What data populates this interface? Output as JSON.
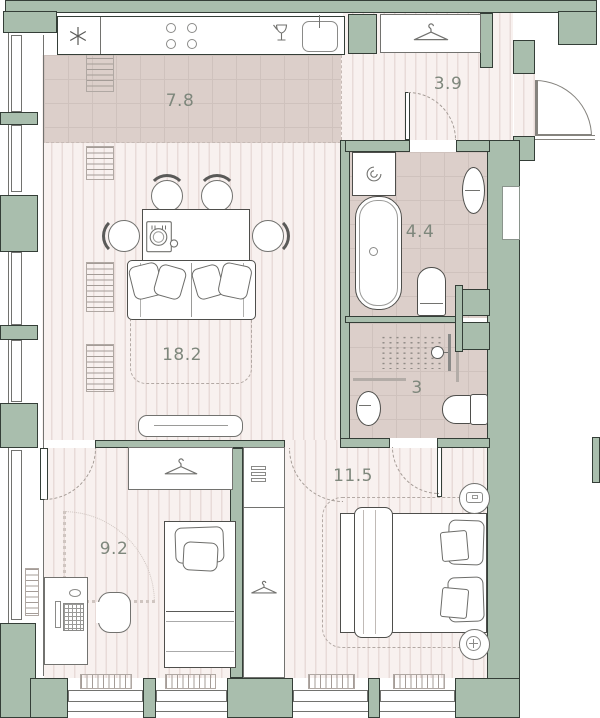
{
  "plan": {
    "rooms": {
      "kitchen": {
        "area": "7.8",
        "fixtures": [
          "fridge-icon",
          "hob-icon",
          "glass-icon",
          "sink-icon"
        ]
      },
      "hallway": {
        "area": "3.9",
        "fixtures": [
          "hanger-icon",
          "entrance-door"
        ]
      },
      "bathroom": {
        "area": "4.4",
        "fixtures": [
          "washing-machine-icon",
          "bathtub",
          "basin",
          "toilet"
        ]
      },
      "shower_room": {
        "area": "3",
        "fixtures": [
          "shower-head-icon",
          "basin",
          "toilet"
        ]
      },
      "living": {
        "area": "18.2",
        "fixtures": [
          "dining-table",
          "dining-chairs",
          "place-setting-icon",
          "sofa",
          "rug",
          "tv-console"
        ]
      },
      "bedroom_small": {
        "area": "9.2",
        "fixtures": [
          "wardrobe-hanger-icon",
          "single-bed",
          "desk",
          "keyboard-icon",
          "office-chair",
          "tall-cabinet",
          "shelves-icon"
        ]
      },
      "bedroom_master": {
        "area": "11.5",
        "fixtures": [
          "double-bed",
          "nightstand-remote-icon",
          "nightstand-plus-icon",
          "rug"
        ]
      }
    },
    "colors": {
      "wall": "#a9bead",
      "wall_outline": "#343e37",
      "wet_floor": "#dccfca",
      "dry_floor": "#f8f1ef",
      "floor_stripe": "#e8dbd8",
      "label_text": "#7e877c"
    }
  }
}
